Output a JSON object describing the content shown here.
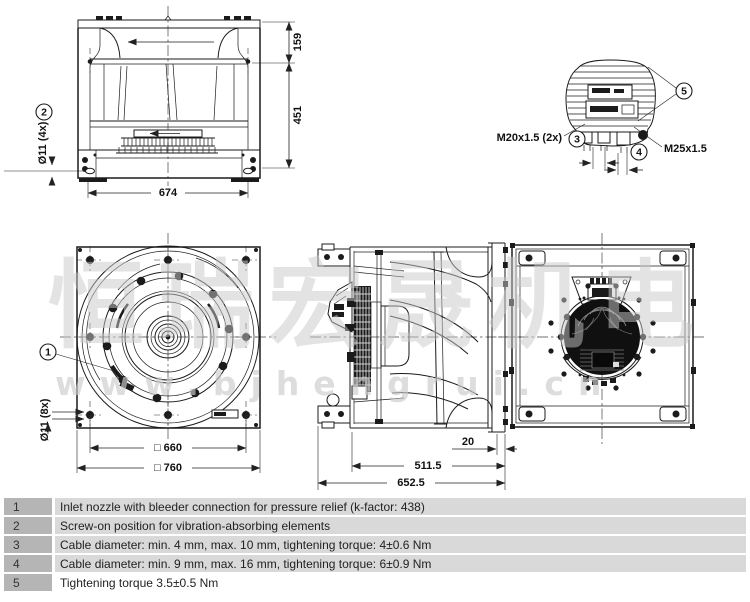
{
  "watermark": {
    "brand_cjk": "恒瑞宏晟机电",
    "brand_url": "www.bjhengrui.cn"
  },
  "drawing": {
    "callouts": {
      "c1": "1",
      "c2": "2",
      "c3": "3",
      "c4": "4",
      "c5": "5"
    },
    "side_view": {
      "height_top": "159",
      "height_mid": "451",
      "width": "674",
      "mount_holes": "Ø11 (4x)"
    },
    "terminal_detail": {
      "gland_small": "M20x1.5 (2x)",
      "gland_large": "M25x1.5"
    },
    "front_view": {
      "hole_square": "□ 660",
      "outer_square": "□ 760",
      "mount_holes": "Ø11 (8x)"
    },
    "depth_view": {
      "flange_offset": "20",
      "inner_depth": "511.5",
      "total_depth": "652.5"
    }
  },
  "notes": [
    {
      "num": "1",
      "text": "Inlet nozzle with bleeder connection for pressure relief (k-factor: 438)"
    },
    {
      "num": "2",
      "text": "Screw-on position for vibration-absorbing elements"
    },
    {
      "num": "3",
      "text": "Cable diameter: min. 4 mm, max. 10 mm, tightening torque: 4±0.6 Nm"
    },
    {
      "num": "4",
      "text": "Cable diameter: min. 9 mm, max. 16 mm, tightening torque: 6±0.9 Nm"
    },
    {
      "num": "5",
      "text": "Tightening torque 3.5±0.5 Nm"
    }
  ]
}
